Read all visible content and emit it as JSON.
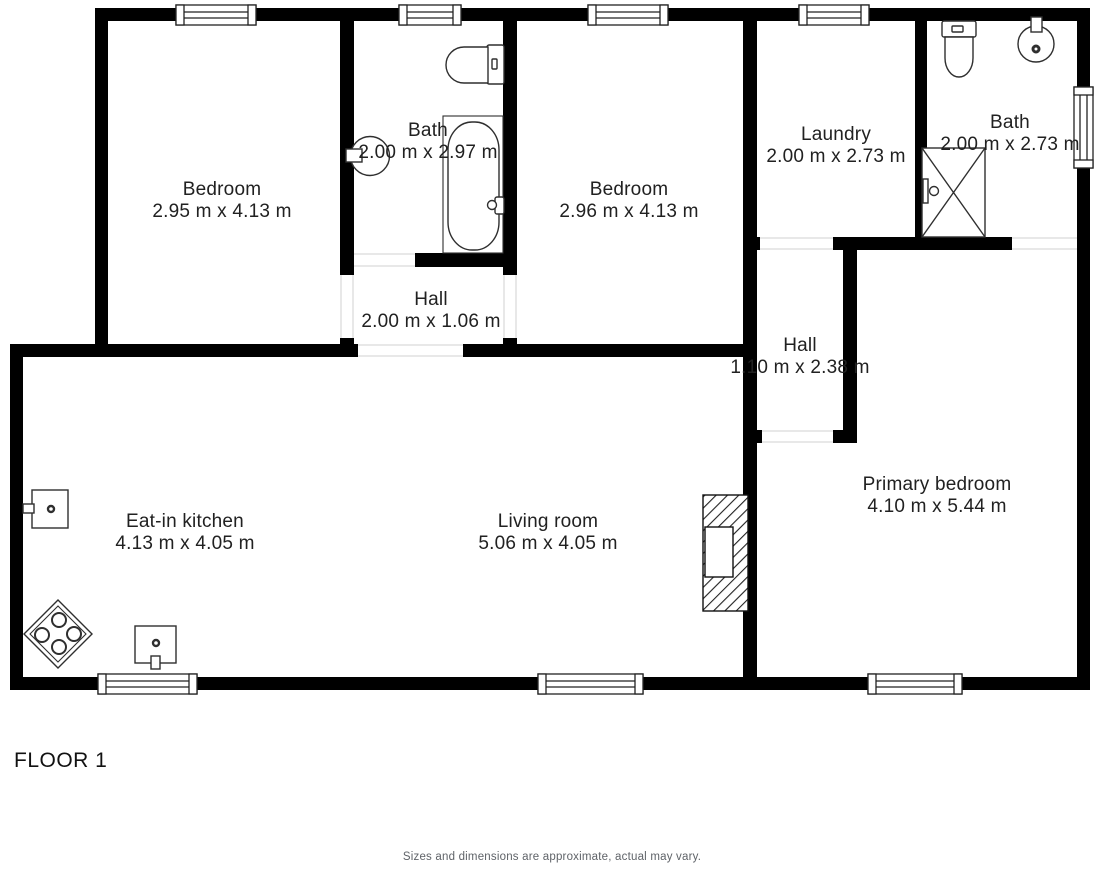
{
  "floor_label": "FLOOR 1",
  "disclaimer": "Sizes and dimensions are approximate, actual may vary.",
  "rooms": {
    "bedroom1": {
      "name": "Bedroom",
      "dims": "2.95 m x 4.13 m"
    },
    "bath1": {
      "name": "Bath",
      "dims": "2.00 m x 2.97 m"
    },
    "hall1": {
      "name": "Hall",
      "dims": "2.00 m x 1.06 m"
    },
    "bedroom2": {
      "name": "Bedroom",
      "dims": "2.96 m x 4.13 m"
    },
    "laundry": {
      "name": "Laundry",
      "dims": "2.00 m x 2.73 m"
    },
    "bath2": {
      "name": "Bath",
      "dims": "2.00 m x 2.73 m"
    },
    "hall2": {
      "name": "Hall",
      "dims": "1.10 m x 2.38 m"
    },
    "kitchen": {
      "name": "Eat-in kitchen",
      "dims": "4.13 m x 4.05 m"
    },
    "living": {
      "name": "Living room",
      "dims": "5.06 m x 4.05 m"
    },
    "primary": {
      "name": "Primary bedroom",
      "dims": "4.10 m x 5.44 m"
    }
  },
  "colors": {
    "background": "#ffffff",
    "wall": "#000000",
    "room_text": "#212121",
    "fixture_stroke": "#2f2f2f",
    "door_opening_line": "#d9d9d9",
    "disclaimer_text": "#5f6368"
  }
}
